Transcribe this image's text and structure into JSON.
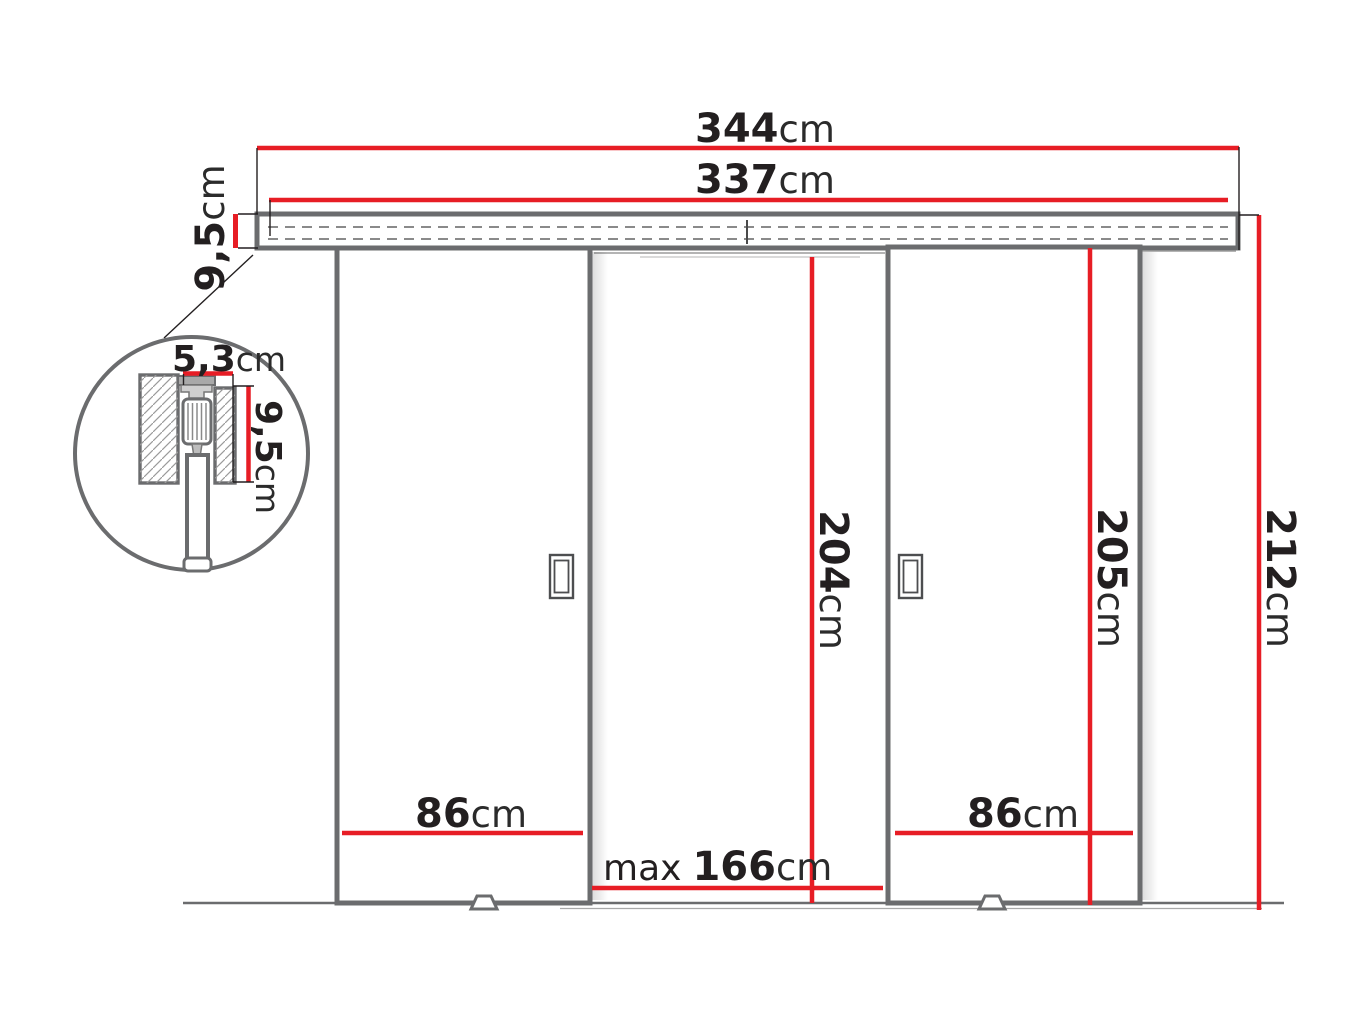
{
  "drawing": {
    "type": "technical-diagram",
    "subject": "double sliding doors with top track, front elevation with track cross-section detail",
    "colors": {
      "dimension_red": "#e71d25",
      "outline_gray": "#6b6c6e",
      "text_dark": "#231f20"
    },
    "dim_track_outer": {
      "value": "344",
      "unit": "cm"
    },
    "dim_track_rail": {
      "value": "337",
      "unit": "cm"
    },
    "dim_track_height": {
      "value": "9,5",
      "unit": "cm"
    },
    "dim_left_door_width": {
      "value": "86",
      "unit": "cm"
    },
    "dim_right_door_width": {
      "value": "86",
      "unit": "cm"
    },
    "dim_opening_width": {
      "prefix": "max",
      "value": "166",
      "unit": "cm"
    },
    "dim_opening_height": {
      "value": "204",
      "unit": "cm"
    },
    "dim_door_height": {
      "value": "205",
      "unit": "cm"
    },
    "dim_total_height": {
      "value": "212",
      "unit": "cm"
    },
    "detail": {
      "dim_profile_width": {
        "value": "5,3",
        "unit": "cm"
      },
      "dim_profile_height": {
        "value": "9,5",
        "unit": "cm"
      }
    }
  }
}
